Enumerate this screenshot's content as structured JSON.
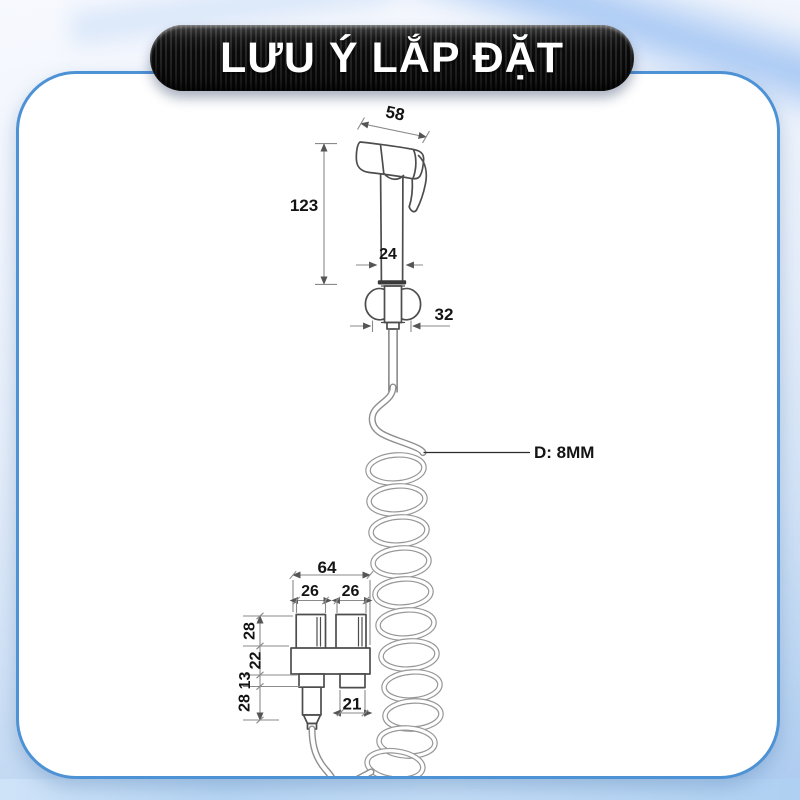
{
  "title_banner": {
    "text": "LƯU Ý LẮP ĐẶT"
  },
  "diagram": {
    "dimensions": {
      "head_width": "58",
      "sprayer_height": "123",
      "handle_width": "24",
      "connector_width": "32",
      "hose_diameter_label": "D: 8MM",
      "bracket_total_width": "64",
      "left_port_width": "26",
      "right_port_width": "26",
      "upper_height": "28",
      "mid_height": "22",
      "lip_height": "13",
      "lower_height": "28",
      "right_outlet_width": "21"
    }
  },
  "theme": {
    "card_border": "#4e92d6",
    "card_background": "#ffffff",
    "banner_background": "#101010",
    "banner_text_color": "#ffffff",
    "page_background_top": "#f7f9fe",
    "page_background_bottom": "#accbf0",
    "line_color": "#4d4d4d",
    "coil_color": "#979797",
    "dimension_text_color": "#141414"
  }
}
